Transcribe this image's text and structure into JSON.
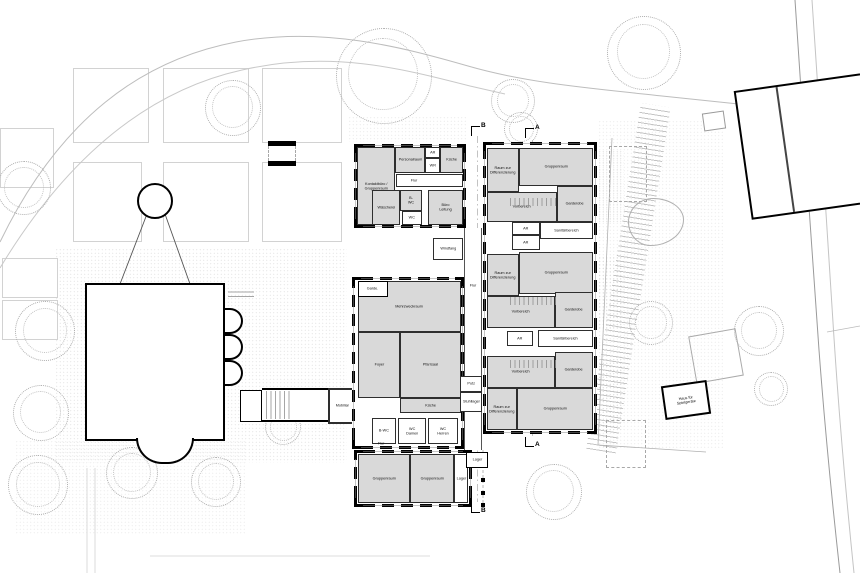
{
  "plan": {
    "markers": {
      "a": "A",
      "b": "B"
    },
    "labels": {
      "kontaktbuero": "Kontaktbüro / Gruppenraum",
      "personalraum": "Personalraum",
      "ar": "AR",
      "kueche": "Küche",
      "wr": "WR",
      "flur": "Flur",
      "waescherei": "Wäscherei",
      "bwc": "B-WC",
      "wc": "WC",
      "buero_leitung": "Büro Leitung",
      "raum_zur_differenzierung": "Raum zur Differenzierung",
      "gruppenraum": "Gruppenraum",
      "vorbereich": "Vorbereich",
      "garderobe": "Garderobe",
      "sanitaerbereich": "Sanitärbereich",
      "windfang": "Windfang",
      "putz": "Putz",
      "stuhllager": "Stuhllager",
      "garde": "Garde.",
      "mehrzweckraum": "Mehrzweckraum",
      "foyer": "Foyer",
      "pfarrsaal": "Pfarrsaal",
      "wc_damen": "WC Damen",
      "wc_herren": "WC Herren",
      "mobiliar": "Mobiliar",
      "lager": "Lager",
      "haus_fuer_spielgeraete": "Haus für Spielgeräte"
    },
    "colors": {
      "room_fill": "#d9d9d9",
      "wall": "#000000",
      "site_line": "#9a9a9a",
      "tree": "#b0b0b0"
    }
  }
}
